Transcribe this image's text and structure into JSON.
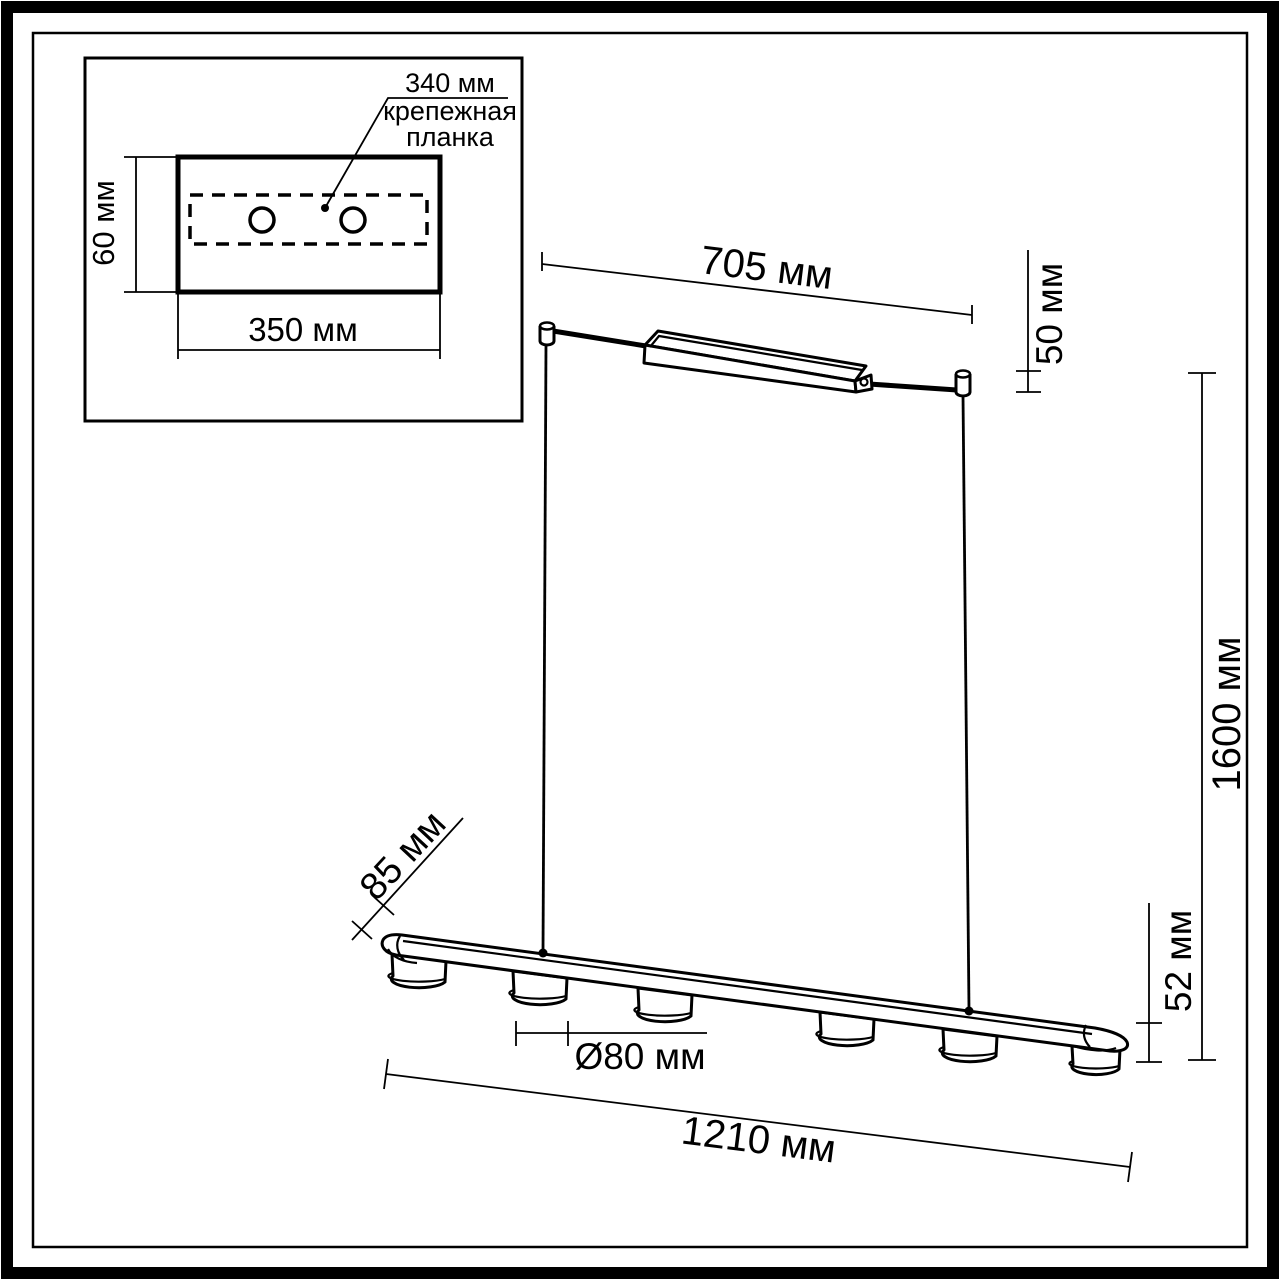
{
  "inset": {
    "bracket_length_label": "340 мм",
    "bracket_caption_line1": "крепежная",
    "bracket_caption_line2": "планка",
    "plate_height_label": "60 мм",
    "plate_width_label": "350 мм"
  },
  "dimensions": {
    "canopy_length": "705 мм",
    "canopy_height": "50 мм",
    "drop_height": "1600 мм",
    "fixture_depth": "85 мм",
    "fixture_height": "52 мм",
    "spot_diameter": "Ø80 мм",
    "fixture_length": "1210 мм"
  },
  "colors": {
    "line": "#000000",
    "background": "#ffffff"
  }
}
